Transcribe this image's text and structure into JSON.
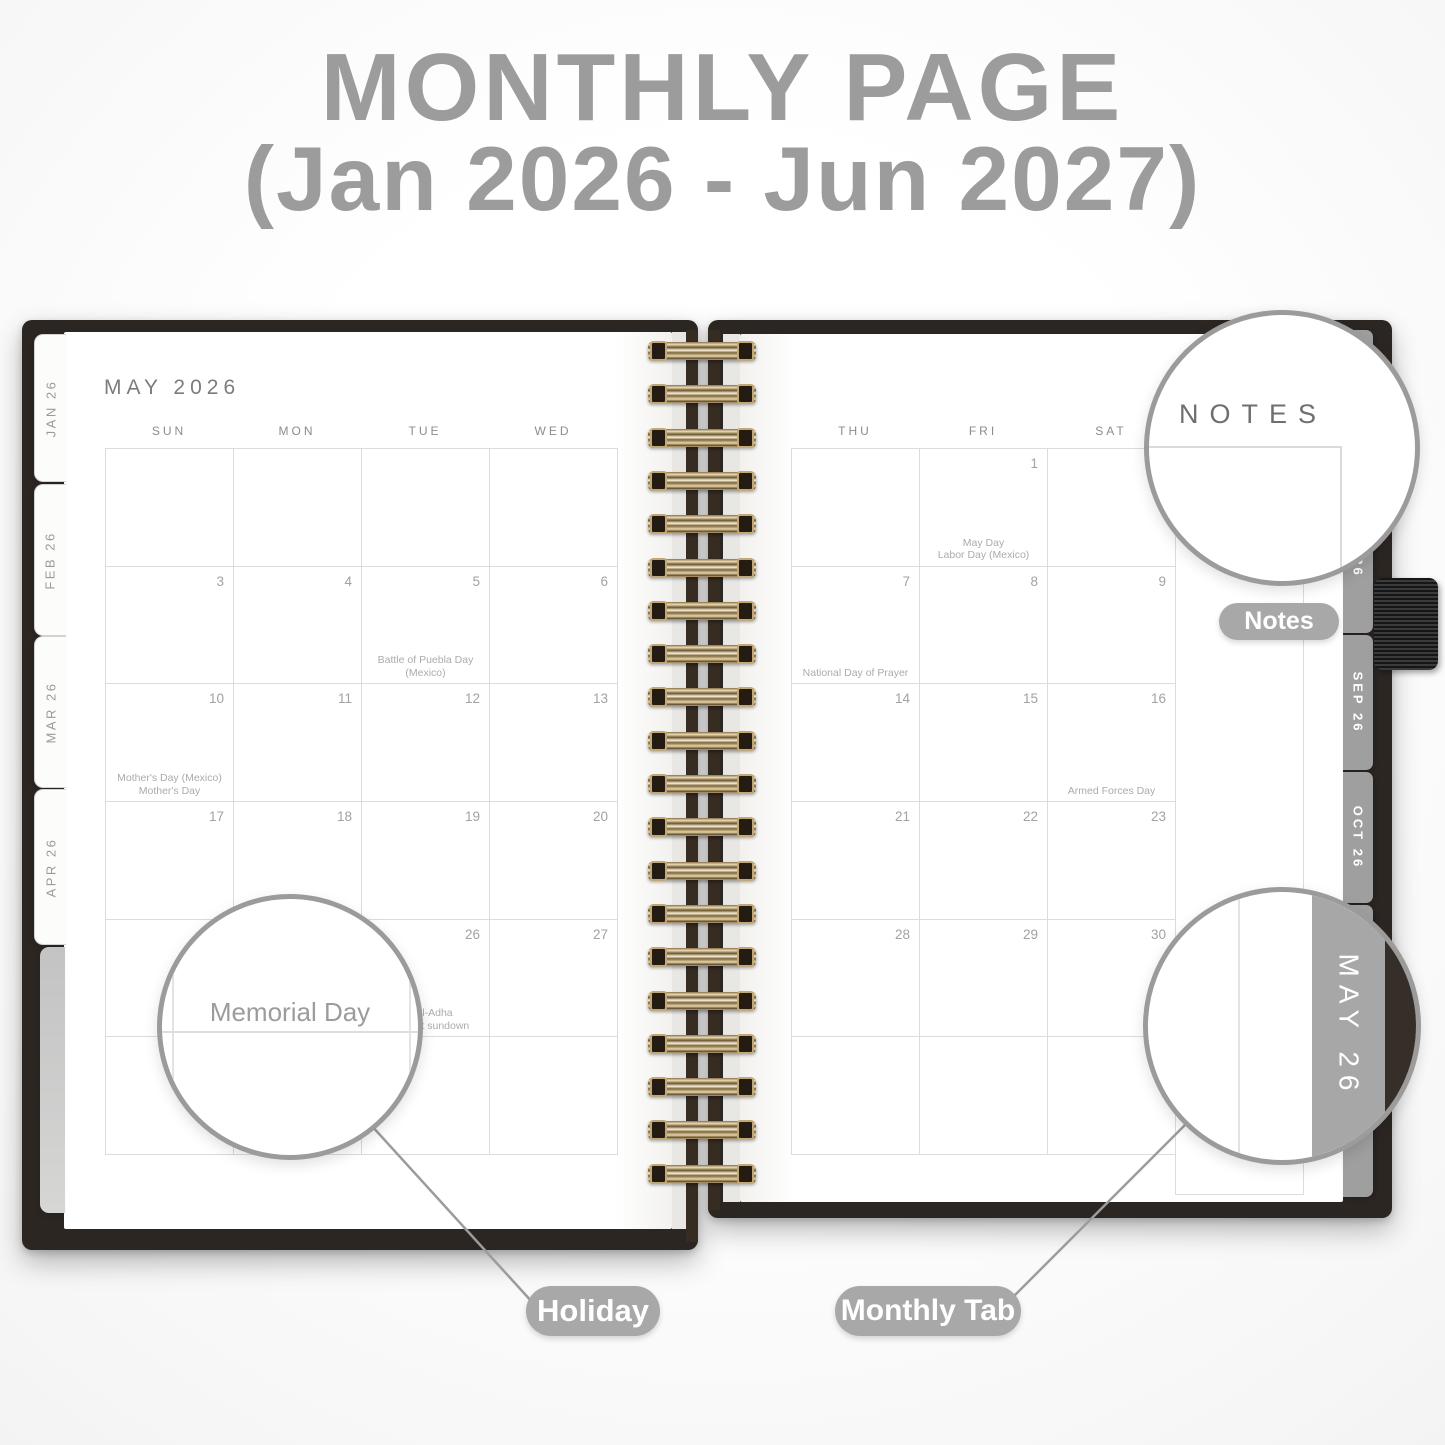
{
  "title": {
    "line1": "MONTHLY PAGE",
    "line2": "(Jan 2026 - Jun 2027)"
  },
  "page": {
    "month_title": "MAY 2026",
    "day_headers_left": [
      "SUN",
      "MON",
      "TUE",
      "WED"
    ],
    "day_headers_right": [
      "THU",
      "FRI",
      "SAT"
    ],
    "left_tabs": [
      {
        "label": "JAN 26"
      },
      {
        "label": "FEB 26"
      },
      {
        "label": "MAR 26"
      },
      {
        "label": "APR 26"
      }
    ],
    "right_tabs": [
      {
        "label": ""
      },
      {
        "label": ""
      },
      {
        "label": "26"
      },
      {
        "label": "SEP 26"
      },
      {
        "label": "OCT 26"
      },
      {
        "label": ""
      },
      {
        "label": "26"
      }
    ]
  },
  "calendar": {
    "left_rows": [
      [
        {
          "d": ""
        },
        {
          "d": ""
        },
        {
          "d": ""
        },
        {
          "d": ""
        }
      ],
      [
        {
          "d": "3"
        },
        {
          "d": "4"
        },
        {
          "d": "5",
          "ev": [
            "Battle of Puebla Day",
            "(Mexico)"
          ]
        },
        {
          "d": "6"
        }
      ],
      [
        {
          "d": "10",
          "ev": [
            "Mother's Day (Mexico)",
            "Mother's Day"
          ]
        },
        {
          "d": "11"
        },
        {
          "d": "12"
        },
        {
          "d": "13"
        }
      ],
      [
        {
          "d": "17"
        },
        {
          "d": "18"
        },
        {
          "d": "19"
        },
        {
          "d": "20"
        }
      ],
      [
        {
          "d": ""
        },
        {
          "d": ""
        },
        {
          "d": "26",
          "ev": [
            "Eid al-Adha",
            "begins at sundown"
          ]
        },
        {
          "d": "27"
        }
      ],
      [
        {
          "d": ""
        },
        {
          "d": ""
        },
        {
          "d": ""
        },
        {
          "d": ""
        }
      ]
    ],
    "right_rows": [
      [
        {
          "d": ""
        },
        {
          "d": "1",
          "ev": [
            "May Day",
            "Labor Day (Mexico)"
          ]
        },
        {
          "d": ""
        }
      ],
      [
        {
          "d": "7",
          "ev": [
            "National Day of Prayer"
          ]
        },
        {
          "d": "8"
        },
        {
          "d": "9"
        }
      ],
      [
        {
          "d": "14"
        },
        {
          "d": "15"
        },
        {
          "d": "16",
          "ev": [
            "Armed Forces Day"
          ]
        }
      ],
      [
        {
          "d": "21"
        },
        {
          "d": "22"
        },
        {
          "d": "23"
        }
      ],
      [
        {
          "d": "28"
        },
        {
          "d": "29"
        },
        {
          "d": "30"
        }
      ],
      [
        {
          "d": ""
        },
        {
          "d": ""
        },
        {
          "d": ""
        }
      ]
    ]
  },
  "magnifiers": {
    "notes_header": "NOTES",
    "holiday_example": "Memorial Day",
    "monthly_tab_example": "MAY 26"
  },
  "callouts": {
    "notes": "Notes",
    "holiday": "Holiday",
    "monthly_tab": "Monthly Tab"
  },
  "colors": {
    "title_gray": "#9c9c9c",
    "cover": "#2c2623",
    "tab_gray": "#9f9f9f",
    "spiral_gold": "#c2a877",
    "pill_gray": "#a8a8a8"
  }
}
